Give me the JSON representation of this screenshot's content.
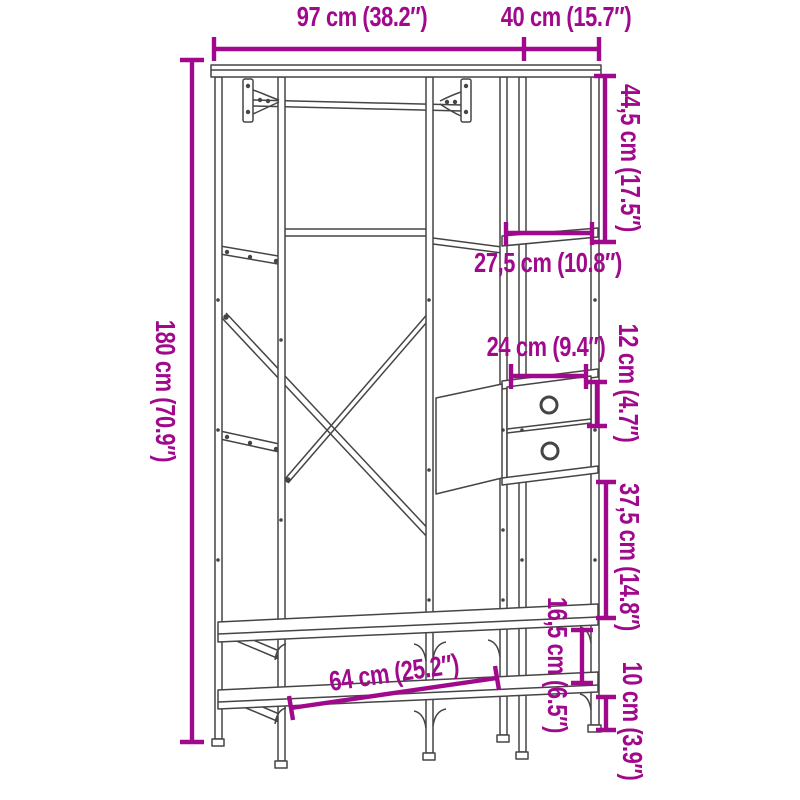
{
  "colors": {
    "dimension_annotation": "#A1098C",
    "line_art": "#454545",
    "background": "#FFFFFF"
  },
  "dims": {
    "top_width": "97 cm (38.2″)",
    "top_depth": "40 cm (15.7″)",
    "total_height": "180 cm (70.9″)",
    "upper_shelf_height": "44,5 cm (17.5″)",
    "shelf_depth": "27,5 cm (10.8″)",
    "drawer_width": "24 cm (9.4″)",
    "drawer_height": "12 cm (4.7″)",
    "mid_gap_height": "37,5 cm (14.8″)",
    "lower_gap_height": "16,5 cm (6.5″)",
    "bottom_clearance": "10 cm (3.9″)",
    "bench_width": "64 cm (25.2″)"
  }
}
